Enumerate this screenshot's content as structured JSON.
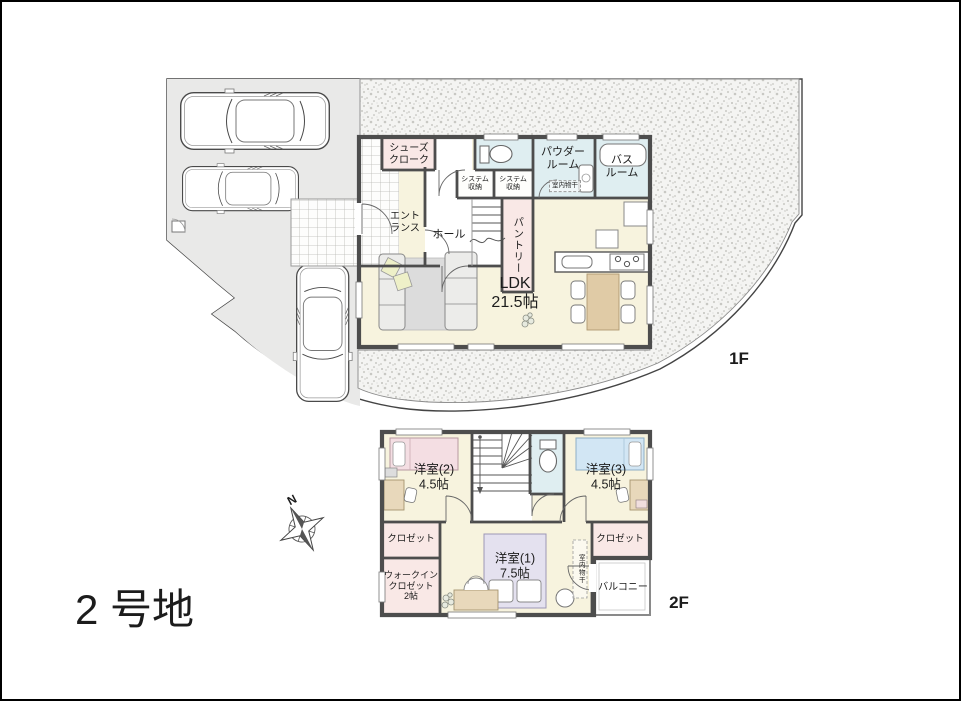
{
  "lot": {
    "label": "2 号地"
  },
  "compass": {
    "north": "N"
  },
  "floor1": {
    "floor_label": "1F",
    "rooms": {
      "shoes_cloak": "シューズ\nクローク",
      "entrance": "エント\nランス",
      "hall": "ホール",
      "system_storage_left": "システム\n収納",
      "system_storage_right": "システム\n収納",
      "powder_room": "パウダー\nルーム",
      "indoor_drying": "室内物干",
      "bath_room": "バス\nルーム",
      "pantry": "パントリー",
      "ldk": "LDK\n21.5帖"
    }
  },
  "floor2": {
    "floor_label": "2F",
    "rooms": {
      "bedroom2": "洋室(2)\n4.5帖",
      "bedroom3": "洋室(3)\n4.5帖",
      "bedroom1": "洋室(1)\n7.5帖",
      "closet_left": "クロゼット",
      "closet_right": "クロゼット",
      "walk_in_closet": "ウォークイン\nクロゼット\n2帖",
      "indoor_drying": "室内物干",
      "balcony": "バルコニー"
    }
  },
  "colors": {
    "wall": "#4d4d4d",
    "room_cream": "#f7f3de",
    "room_pink": "#f9e8e6",
    "room_blue": "#dfeef1",
    "site_gray": "#e9e9e8",
    "bed_pink": "#f4dee3",
    "bed_blue": "#d2e6f4",
    "bed_lavender": "#e4e1ef",
    "wood": "#e8d8bb",
    "table_wood": "#e0cba6"
  }
}
